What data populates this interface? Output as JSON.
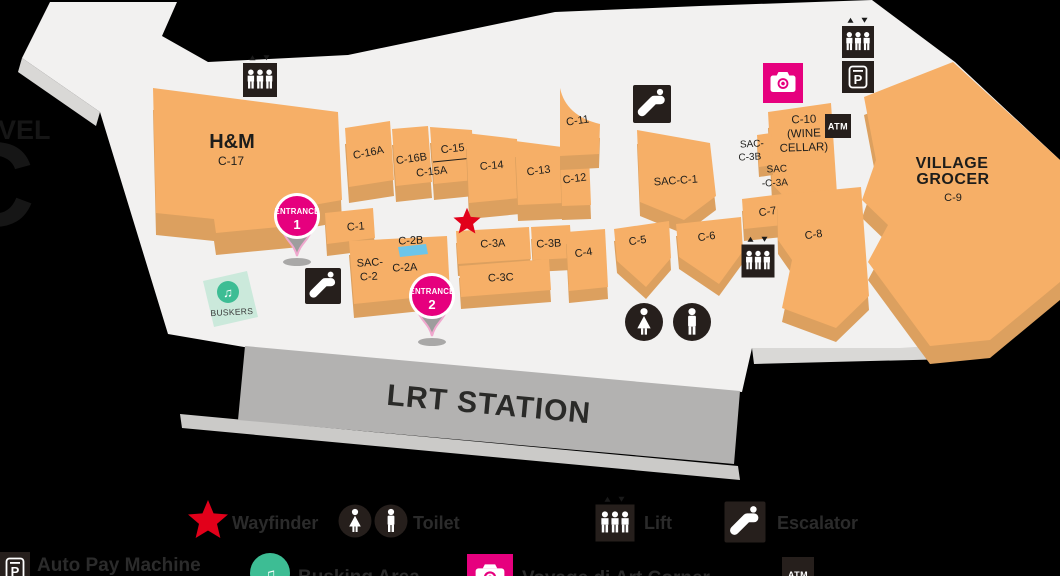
{
  "colors": {
    "background": "#000000",
    "floor": "#F2F1F0",
    "store_top": "#F6AF67",
    "store_side": "#DCA05F",
    "icon_dark": "#261F1C",
    "accent_pink": "#E6007E",
    "wayfinder_red": "#E2001A",
    "busking_teal": "#3DBD94",
    "busking_light": "#CBE9DB",
    "lrt_gray": "#B3B2B1",
    "c2b_blue": "#6CC5E9"
  },
  "level": {
    "line1": "VEL",
    "line2": "C"
  },
  "glyphs": {
    "parking": "P",
    "music_note": "♫"
  },
  "map": {
    "stores": {
      "hm": {
        "name": "H&M",
        "unit": "C-17"
      },
      "c16a": {
        "unit": "C-16A"
      },
      "c16b": {
        "unit": "C-16B"
      },
      "c15": {
        "unit": "C-15"
      },
      "c15a": {
        "unit": "C-15A"
      },
      "c14": {
        "unit": "C-14"
      },
      "c13": {
        "unit": "C-13"
      },
      "c12": {
        "unit": "C-12"
      },
      "c11": {
        "unit": "C-11"
      },
      "sacc1": {
        "unit": "SAC-C-1"
      },
      "c10": {
        "line1": "C-10",
        "line2": "(WINE",
        "line3": "CELLAR)"
      },
      "sacc3b": {
        "line1": "SAC-",
        "line2": "C-3B"
      },
      "sacc3a": {
        "line1": "SAC",
        "line2": "-C-3A"
      },
      "village": {
        "name1": "VILLAGE",
        "name2": "GROCER",
        "unit": "C-9"
      },
      "c1": {
        "unit": "C-1"
      },
      "c2b": {
        "unit": "C-2B"
      },
      "sacc2": {
        "line1": "SAC-",
        "line2": "C-2"
      },
      "c2a": {
        "unit": "C-2A"
      },
      "c3a": {
        "unit": "C-3A"
      },
      "c3b": {
        "unit": "C-3B"
      },
      "c3c": {
        "unit": "C-3C"
      },
      "c4": {
        "unit": "C-4"
      },
      "c5": {
        "unit": "C-5"
      },
      "c6": {
        "unit": "C-6"
      },
      "c7": {
        "unit": "C-7"
      },
      "c8": {
        "unit": "C-8"
      }
    },
    "areas": {
      "buskers": {
        "label": "BUSKERS"
      },
      "lrt": {
        "label": "LRT STATION"
      }
    },
    "entrances": {
      "e1": {
        "label": "ENTRANCE",
        "number": "1"
      },
      "e2": {
        "label": "ENTRANCE",
        "number": "2"
      }
    },
    "icons": {
      "atm": "ATM"
    }
  },
  "legend": {
    "wayfinder": "Wayfinder",
    "toilet": "Toilet",
    "lift": "Lift",
    "escalator": "Escalator",
    "auto_pay": "Auto Pay Machine",
    "busking": "Busking Area",
    "art_corner": "Voyage di Art Corner",
    "atm": "ATM"
  }
}
